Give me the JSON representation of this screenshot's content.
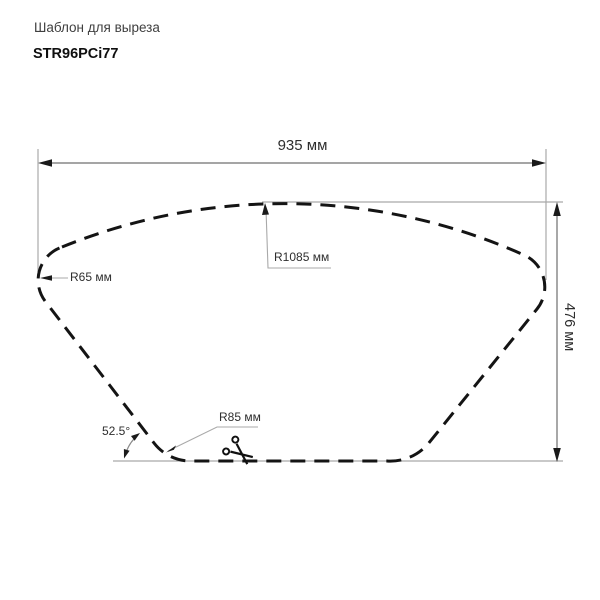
{
  "header": {
    "subtitle": "Шаблон для выреза",
    "model": "STR96PCi77"
  },
  "dimensions": {
    "width": "935 мм",
    "height": "476 мм",
    "corner_radius": "R65 мм",
    "top_radius": "R1085 мм",
    "bottom_radius": "R85 мм",
    "side_angle": "52.5°"
  },
  "icons": {
    "scissors": "cut-along-line-scissors"
  },
  "colors": {
    "outline": "#141414",
    "dimension_lines": "#a9a9a9",
    "label_text": "#2e2e2e"
  }
}
